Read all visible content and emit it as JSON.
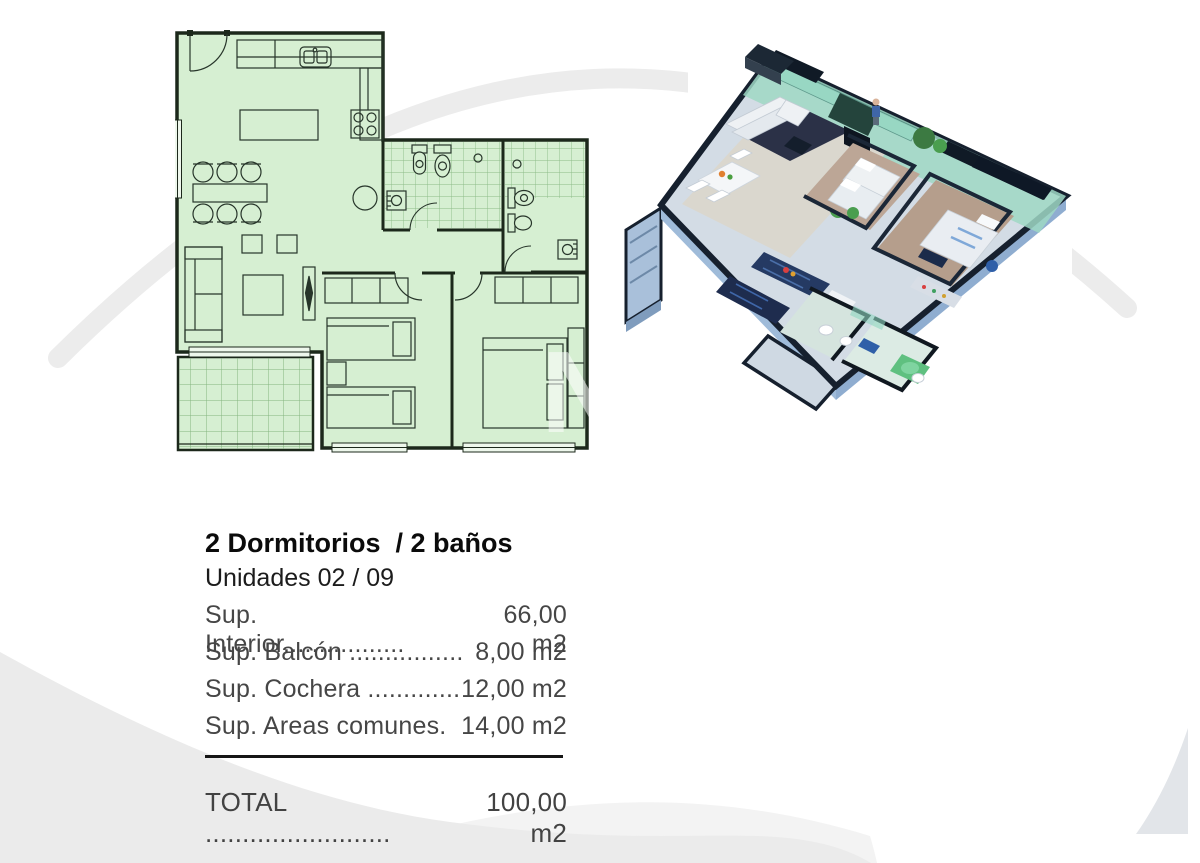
{
  "page": {
    "width_px": 1200,
    "height_px": 863,
    "background_color": "#ffffff"
  },
  "decor": {
    "swoosh_arc_color": "#ececec",
    "swoosh_band_color": "#ebebeb",
    "corner_wedge_color": "#e2e5e9",
    "watermark_letter": "N"
  },
  "floorplan_2d": {
    "kind": "2d-architectural-plan",
    "fill_color": "#d6efd2",
    "line_color": "#22301f",
    "features": [
      "entry-door",
      "kitchen-counter",
      "kitchen-sink",
      "stove",
      "kitchen-island",
      "dining-table",
      "six-chairs",
      "sofa",
      "side-tables",
      "rug",
      "tv-unit",
      "laundry-circle",
      "bathroom-1-tiled",
      "bathroom-2",
      "bedroom-1-two-beds",
      "bedroom-1-closet",
      "bedroom-2-double-bed",
      "bedroom-2-closet",
      "balcony-tiled-terrace",
      "windows"
    ]
  },
  "render_3d": {
    "kind": "3d-isometric-cutaway-render",
    "wall_top_color": "#141e2e",
    "wall_face_color": "#a9c3dd",
    "slab_color": "#9fbbd9",
    "floor_living_color": "#dad7ce",
    "floor_bedroom_color": "#b59e8c",
    "rug_color": "#2b3147",
    "kitchen_cabinet_color": "#1e2c4e",
    "terrace_glass_color": "#8fd6c0",
    "accent_blue": "#3c6db0",
    "bath_green": "#5fc080",
    "plant_color": "#3c7a42",
    "features": [
      "terrace-glass-balcony",
      "l-sofa",
      "dark-rug",
      "dining-table",
      "kitchen-island",
      "fridge",
      "bedroom-1-beds",
      "master-bed",
      "bathrooms",
      "plants",
      "person-figure",
      "garage-stub"
    ]
  },
  "unit_info": {
    "title": "2 Dormitorios  / 2 baños",
    "subtitle": "Unidades 02 / 09",
    "rows": [
      {
        "label": "Sup. Interior.................",
        "value": "66,00 m2"
      },
      {
        "label": "Sup. Balcón ................",
        "value": "8,00 m2"
      },
      {
        "label": "Sup. Cochera .............",
        "value": "12,00 m2"
      },
      {
        "label": "Sup. Areas comunes.",
        "value": "14,00 m2"
      }
    ],
    "total": {
      "label": "TOTAL .........................",
      "value": "100,00 m2"
    }
  }
}
